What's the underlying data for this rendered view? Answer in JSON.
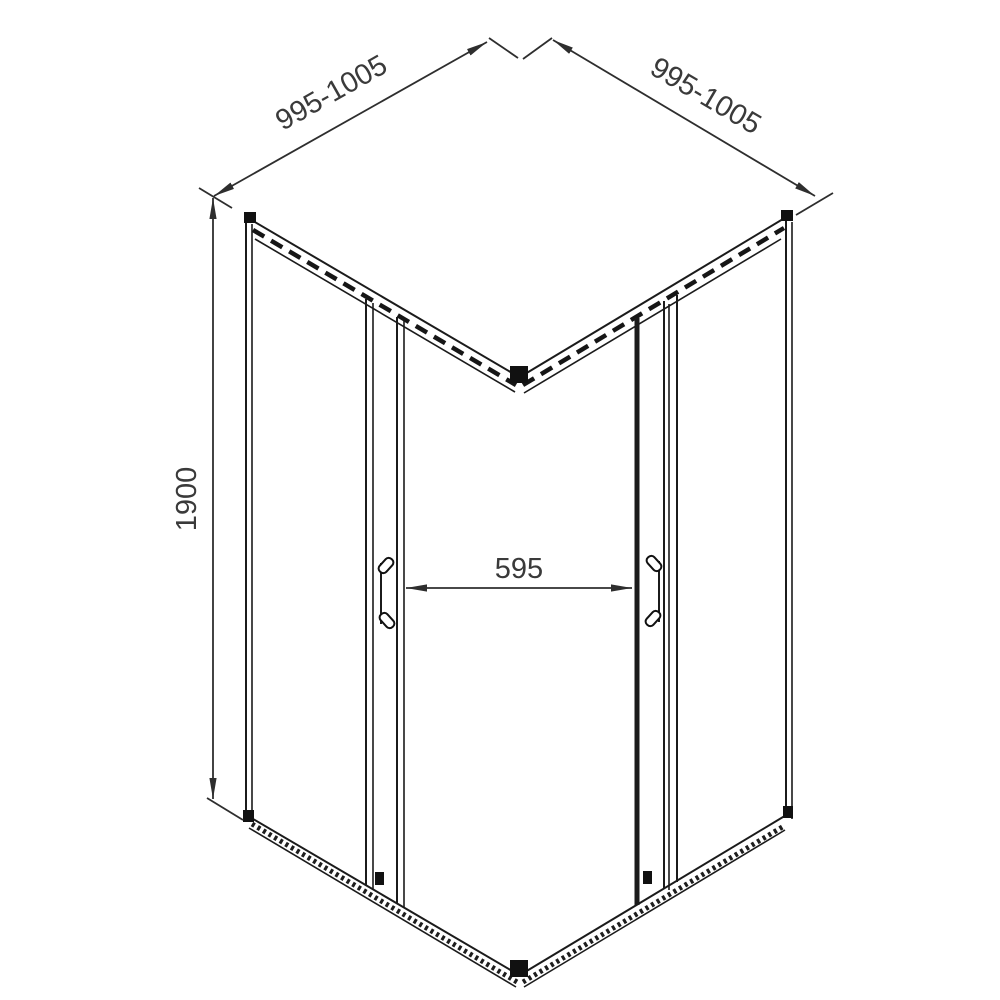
{
  "drawing": {
    "title": "corner shower enclosure technical drawing",
    "view": "isometric outline drawing, square corner-entry enclosure with two sliding doors",
    "dimensions": {
      "left_width": "995-1005",
      "right_width": "995-1005",
      "height": "1900",
      "entry_width": "595"
    },
    "units_note": "",
    "colors": {
      "line": "#1b1b1b",
      "dimension_line": "#2e2e2e",
      "dimension_text": "#3a3a3a",
      "background": "#ffffff"
    }
  }
}
